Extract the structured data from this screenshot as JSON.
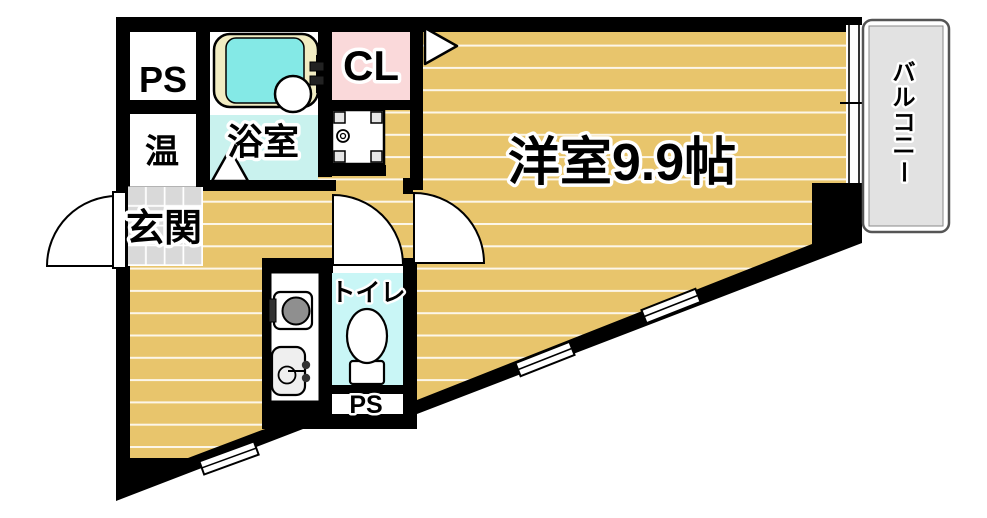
{
  "title": "apartment-floor-plan",
  "labels": {
    "ps_top": "PS",
    "water_heater": "温",
    "bathroom": "浴室",
    "closet": "CL",
    "main_room": "洋室9.9帖",
    "entrance": "玄関",
    "toilet": "トイレ",
    "ps_bottom": "PS",
    "balcony": "バルコニー",
    "balcony_chars": [
      "バ",
      "ル",
      "コ",
      "ニ",
      "ー"
    ]
  },
  "rooms": [
    {
      "name": "pipe-space-top",
      "label": "PS"
    },
    {
      "name": "water-heater",
      "label": "温"
    },
    {
      "name": "bathroom",
      "label": "浴室"
    },
    {
      "name": "closet",
      "label": "CL"
    },
    {
      "name": "entrance",
      "label": "玄関"
    },
    {
      "name": "toilet",
      "label": "トイレ"
    },
    {
      "name": "main-room",
      "label": "洋室9.9帖",
      "area_tatami": "9.9帖"
    },
    {
      "name": "pipe-space-bottom",
      "label": "PS"
    },
    {
      "name": "balcony",
      "label": "バルコニー"
    }
  ],
  "colors": {
    "wall": "#000000",
    "floor_tan": "#e8c56c",
    "floor_stripe": "#ffffff",
    "entrance_tile": "#d9d9d9",
    "bath_floor": "#c9f2ee",
    "bathtub": "#84e9e6",
    "tub_rim": "#f1ecc2",
    "closet_pink": "#fad9da",
    "toilet_cyan": "#c9f6f6",
    "balcony_gray": "#e2e2e2",
    "burner_gray": "#8f8f8f"
  }
}
